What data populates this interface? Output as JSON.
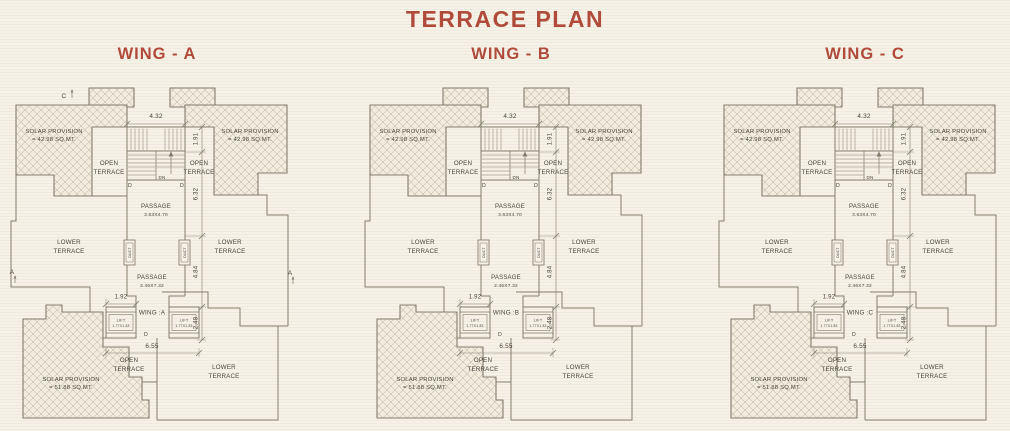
{
  "title": "TERRACE PLAN",
  "colors": {
    "accent": "#b04a3a",
    "line": "#857d6d",
    "text": "#4a453d",
    "bg": "#f7f2e7",
    "hatch_line": "#c6bdab",
    "hatch_fill": "#f2ecdf"
  },
  "wings": [
    {
      "id": "A",
      "heading": "WING - A",
      "plan_label": "WING :A",
      "has_markers": true
    },
    {
      "id": "B",
      "heading": "WING - B",
      "plan_label": "WING :B",
      "has_markers": false
    },
    {
      "id": "C",
      "heading": "WING - C",
      "plan_label": "WING :C",
      "has_markers": false
    }
  ],
  "rooms": {
    "solar_top_1": "SOLAR PROVISION",
    "solar_top_2": "= 42.98 SQ.MT.",
    "solar_bottom_1": "SOLAR PROVISION",
    "solar_bottom_2": "= 51.88 SQ.MT.",
    "open": "OPEN",
    "lower": "LOWER",
    "terrace": "TERRACE",
    "passage": "PASSAGE",
    "passage_upper_size": "3.63X4.70",
    "passage_lower_size": "2.46X7.32",
    "lift": "LIFT",
    "lift_size": "1.77X1.83",
    "duct": "DUCT",
    "dn": "DN",
    "door": "D"
  },
  "dims": {
    "top": "4.32",
    "d191": "1.91",
    "d632": "6.32",
    "d484": "4.84",
    "d248": "2.48",
    "d192": "1.92",
    "d655": "6.55"
  },
  "markers": {
    "top": "C",
    "left": "A",
    "right": "A"
  }
}
